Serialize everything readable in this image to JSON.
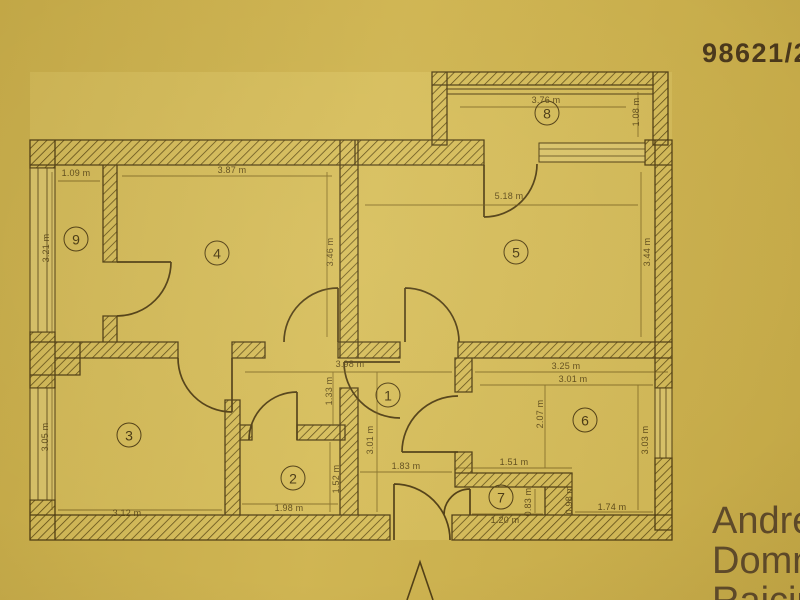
{
  "document": {
    "number": "98621/20",
    "name_lines": [
      "Andre",
      "Domn",
      "Raiciu"
    ]
  },
  "plan": {
    "units": "m",
    "colors": {
      "paper": "#cdb24d",
      "paper_light": "#d5bc59",
      "ink": "#4a3810",
      "dim_ink": "#6a5417"
    },
    "rooms": {
      "r1": {
        "number": "1",
        "width_top": "3.98 m",
        "height_upper": "1.33 m",
        "height_lower": "3.01 m",
        "width_bottom": "1.83 m"
      },
      "r2": {
        "number": "2",
        "width": "1.98 m",
        "height": "1.52 m"
      },
      "r3": {
        "number": "3",
        "width": "3.12 m",
        "height": "3.05 m"
      },
      "r4": {
        "number": "4",
        "width": "3.87 m",
        "height": "3.46 m"
      },
      "r5": {
        "number": "5",
        "width": "5.18 m",
        "height": "3.44 m"
      },
      "r6": {
        "number": "6",
        "width_outer": "3.25 m",
        "width_inner": "3.01 m",
        "height_left": "2.07 m",
        "height_right": "3.03 m",
        "width_bottom": "1.74 m",
        "step_height": "0.98 m"
      },
      "r7": {
        "number": "7",
        "width_top": "1.51 m",
        "width_bottom": "1.20 m",
        "height": "0.83 m"
      },
      "r8": {
        "number": "8",
        "width": "3.76 m",
        "depth": "1.08 m"
      },
      "r9": {
        "number": "9",
        "width": "1.09 m",
        "height": "3.21 m"
      }
    }
  }
}
